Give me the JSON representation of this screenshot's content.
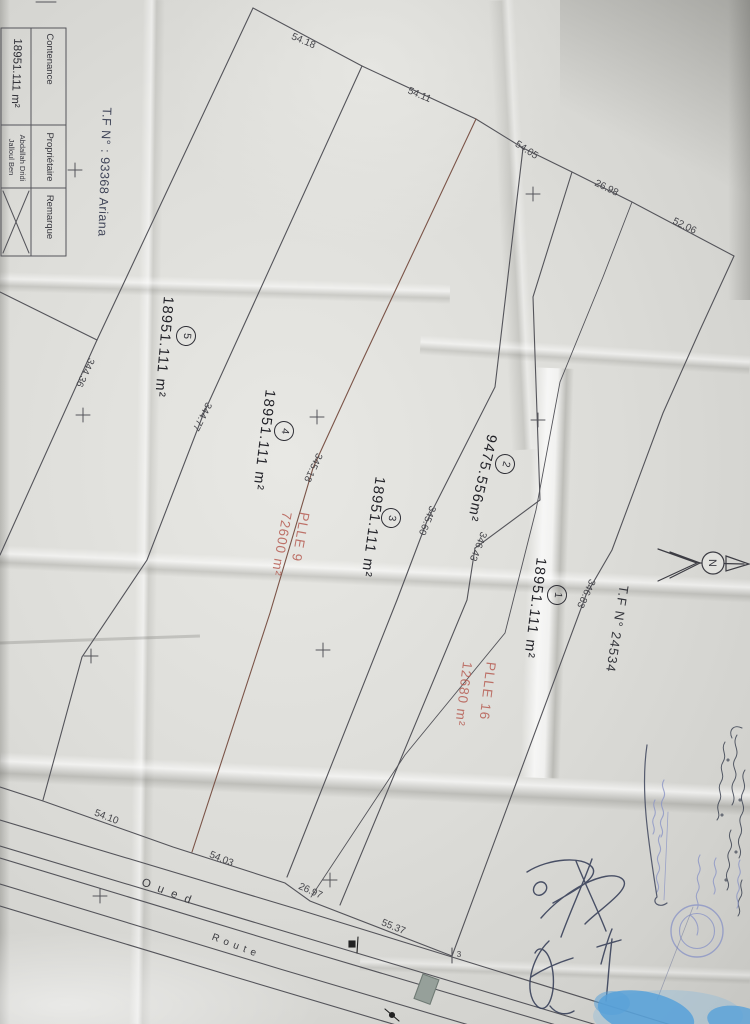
{
  "compass": {
    "label": "N"
  },
  "title_block": {
    "contenance_label": "Contenance",
    "contenance_value": "18951.111 m²",
    "proprietaire_label": "Propriétaire",
    "owner": "Jalloul Ben Abdallah Dridi",
    "remarque_label": "Remarque",
    "tf_reference": "T.F N° : 93368 Ariana"
  },
  "references": {
    "adjacent_title": "T.F N° 24534"
  },
  "parcels": [
    {
      "number": "1",
      "area": "18951.111 m²"
    },
    {
      "number": "2",
      "area": "9475.556m²"
    },
    {
      "number": "3",
      "area": "18951.111 m²"
    },
    {
      "number": "4",
      "area": "18951.111 m²"
    },
    {
      "number": "5",
      "area": "18951.111 m²"
    }
  ],
  "red_overlays": [
    {
      "name": "PLLE 9",
      "area": "72600 m²"
    },
    {
      "name": "PLLE 16",
      "area": "12680 m²"
    }
  ],
  "dimensions_top": [
    "54.18",
    "54.11",
    "54.05",
    "26.98",
    "52.06"
  ],
  "dimensions_cross": [
    "344.36",
    "344.77",
    "345.18",
    "345.60",
    "346.43",
    "346.83"
  ],
  "dimensions_bottom": [
    "54.10",
    "54.03",
    "26.97",
    "55.37"
  ],
  "features": {
    "river": "Oued",
    "road": "Route",
    "corner_mark": "3"
  },
  "map_labels": [
    {
      "name": "dim-54-18",
      "text": "54.18",
      "x": 303,
      "y": 42,
      "rot": 23,
      "cls": "dim"
    },
    {
      "name": "dim-54-11",
      "text": "54.11",
      "x": 419,
      "y": 96,
      "rot": 23,
      "cls": "dim"
    },
    {
      "name": "dim-54-05",
      "text": "54.05",
      "x": 526,
      "y": 151,
      "rot": 33,
      "cls": "dim"
    },
    {
      "name": "dim-26-98",
      "text": "26.98",
      "x": 606,
      "y": 189,
      "rot": 26,
      "cls": "dim"
    },
    {
      "name": "dim-52-06",
      "text": "52.06",
      "x": 684,
      "y": 227,
      "rot": 26,
      "cls": "dim"
    },
    {
      "name": "dim-344-36",
      "text": "344.36",
      "x": 84,
      "y": 372,
      "rot": 115,
      "cls": "dim"
    },
    {
      "name": "dim-344-77",
      "text": "344.77",
      "x": 201,
      "y": 416,
      "rot": 117,
      "cls": "dim"
    },
    {
      "name": "dim-345-18",
      "text": "345.18",
      "x": 312,
      "y": 467,
      "rot": 115,
      "cls": "dim"
    },
    {
      "name": "dim-345-60",
      "text": "345.60",
      "x": 426,
      "y": 520,
      "rot": 112,
      "cls": "dim"
    },
    {
      "name": "dim-346-43",
      "text": "346.43",
      "x": 477,
      "y": 546,
      "rot": 112,
      "cls": "dim"
    },
    {
      "name": "dim-346-83",
      "text": "346.83",
      "x": 585,
      "y": 593,
      "rot": 115,
      "cls": "dim"
    },
    {
      "name": "dim-54-10",
      "text": "54.10",
      "x": 106,
      "y": 818,
      "rot": 21,
      "cls": "dim"
    },
    {
      "name": "dim-54-03",
      "text": "54.03",
      "x": 221,
      "y": 860,
      "rot": 22,
      "cls": "dim"
    },
    {
      "name": "dim-26-97",
      "text": "26.97",
      "x": 310,
      "y": 892,
      "rot": 24,
      "cls": "dim"
    },
    {
      "name": "dim-55-37",
      "text": "55.37",
      "x": 393,
      "y": 928,
      "rot": 22,
      "cls": "dim"
    },
    {
      "name": "corner-point-label",
      "text": "3",
      "x": 459,
      "y": 955,
      "rot": 0,
      "cls": "dim",
      "fs": 8
    },
    {
      "name": "river-label",
      "text": "Oued",
      "x": 170,
      "y": 893,
      "rot": 21,
      "cls": "feat",
      "ls": 8
    },
    {
      "name": "road-label",
      "text": "Route",
      "x": 236,
      "y": 947,
      "rot": 21,
      "cls": "feat",
      "fs": 10,
      "ls": 5
    },
    {
      "name": "parcel-5-area",
      "text": "18951.111 m²",
      "x": 163,
      "y": 347,
      "rot": 95,
      "cls": "parcel"
    },
    {
      "name": "parcel-5-number",
      "text": "5",
      "x": 186,
      "y": 336,
      "rot": 95,
      "cls": "circled"
    },
    {
      "name": "parcel-4-area",
      "text": "18951.111 m²",
      "x": 263,
      "y": 440,
      "rot": 97,
      "cls": "parcel"
    },
    {
      "name": "parcel-4-number",
      "text": "4",
      "x": 284,
      "y": 431,
      "rot": 97,
      "cls": "circled"
    },
    {
      "name": "parcel-3-area",
      "text": "18951.111 m²",
      "x": 372,
      "y": 527,
      "rot": 98,
      "cls": "parcel"
    },
    {
      "name": "parcel-3-number",
      "text": "3",
      "x": 391,
      "y": 518,
      "rot": 98,
      "cls": "circled"
    },
    {
      "name": "parcel-2-area",
      "text": "9475.556m²",
      "x": 481,
      "y": 478,
      "rot": 103,
      "cls": "parcel"
    },
    {
      "name": "parcel-2-number",
      "text": "2",
      "x": 505,
      "y": 464,
      "rot": 103,
      "cls": "circled"
    },
    {
      "name": "parcel-1-area",
      "text": "18951.111 m²",
      "x": 534,
      "y": 608,
      "rot": 97,
      "cls": "parcel"
    },
    {
      "name": "parcel-1-number",
      "text": "1",
      "x": 557,
      "y": 595,
      "rot": 97,
      "cls": "circled"
    },
    {
      "name": "tf-ref-main",
      "text": "T.F N° : 93368 Ariana",
      "x": 104,
      "y": 172,
      "rot": 92,
      "cls": "tf"
    },
    {
      "name": "tf-ref-adjacent",
      "text": "T.F N° 24534",
      "x": 617,
      "y": 629,
      "rot": 99,
      "cls": "tf2"
    },
    {
      "name": "plle9-name",
      "text": "PLLE 9",
      "x": 300,
      "y": 537,
      "rot": 100,
      "cls": "red"
    },
    {
      "name": "plle9-area",
      "text": "72600 m²",
      "x": 281,
      "y": 544,
      "rot": 100,
      "cls": "red"
    },
    {
      "name": "plle16-name",
      "text": "PLLE 16",
      "x": 487,
      "y": 691,
      "rot": 97,
      "cls": "red"
    },
    {
      "name": "plle16-area",
      "text": "12680 m²",
      "x": 463,
      "y": 694,
      "rot": 97,
      "cls": "red"
    },
    {
      "name": "table-contenance-label",
      "text": "Contenance",
      "x": 49,
      "y": 59,
      "rot": 90,
      "cls": "tbl"
    },
    {
      "name": "table-contenance-value",
      "text": "18951.111 m²",
      "x": 16,
      "y": 73,
      "rot": 92,
      "cls": "tblv"
    },
    {
      "name": "table-proprietaire-label",
      "text": "Propriétaire",
      "x": 49,
      "y": 157,
      "rot": 90,
      "cls": "tbl"
    },
    {
      "name": "table-owner-line1",
      "text": "Jalloul Ben",
      "x": 11,
      "y": 157,
      "rot": 90,
      "cls": "tbls"
    },
    {
      "name": "table-owner-line2",
      "text": "Abdallah Dridi",
      "x": 22,
      "y": 158,
      "rot": 90,
      "cls": "tbls"
    },
    {
      "name": "table-remarque-label",
      "text": "Remarque",
      "x": 49,
      "y": 217,
      "rot": 90,
      "cls": "tbl"
    }
  ]
}
